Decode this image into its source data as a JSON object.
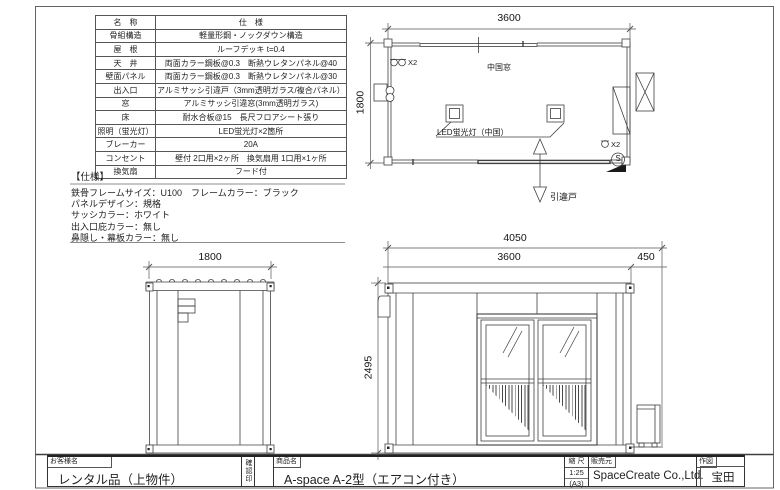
{
  "spec_table": {
    "header": {
      "name": "名　称",
      "spec": "仕　様"
    },
    "rows": [
      {
        "name": "骨組構造",
        "spec": "軽量形鋼・ノックダウン構造"
      },
      {
        "name": "屋　根",
        "spec": "ルーフデッキ t=0.4"
      },
      {
        "name": "天　井",
        "spec": "両面カラー鋼板@0.3　断熱ウレタンパネル@40"
      },
      {
        "name": "壁面パネル",
        "spec": "両面カラー鋼板@0.3　断熱ウレタンパネル@30"
      },
      {
        "name": "出入口",
        "spec": "アルミサッシ引違戸（3mm透明ガラス/複合パネル）"
      },
      {
        "name": "窓",
        "spec": "アルミサッシ引違窓(3mm透明ガラス)"
      },
      {
        "name": "床",
        "spec": "耐水合板@15　長尺フロアシート張り"
      },
      {
        "name": "照明（蛍光灯）",
        "spec": "LED蛍光灯×2箇所"
      },
      {
        "name": "ブレーカー",
        "spec": "20A"
      },
      {
        "name": "コンセント",
        "spec": "壁付 2口用×2ヶ所　換気扇用 1口用×1ヶ所"
      },
      {
        "name": "換気扇",
        "spec": "フード付"
      }
    ]
  },
  "spec_notes": {
    "title": "【仕様】",
    "lines": [
      "鉄骨フレームサイズ：U100　フレームカラー：ブラック",
      "パネルデザイン：規格",
      "サッシカラー：ホワイト",
      "出入口庇カラー：無し",
      "鼻隠し・幕板カラー：無し"
    ]
  },
  "plan": {
    "dim_width": "3600",
    "dim_depth": "1800",
    "window_label": "中国窓",
    "light_label": "LED蛍光灯（中国）",
    "door_label": "引違戸",
    "outlet_count": "X2",
    "switch_letter": "S"
  },
  "side_elevation": {
    "dim_width": "1800"
  },
  "front_elevation": {
    "dim_total": "4050",
    "dim_body": "3600",
    "dim_offset": "450",
    "dim_height": "2495"
  },
  "title_block": {
    "customer_label": "お客様名",
    "customer_value": "レンタル品（上物件）",
    "stamp_label": "確認印",
    "product_label": "商品名",
    "product_value": "A-space A-2型（エアコン付き）",
    "scale_label": "縮 尺",
    "scale_value": "1:25",
    "scale_paper": "(A3)",
    "seller_label": "販売元",
    "seller_value": "SpaceCreate Co.,Ltd.",
    "author_label": "作図",
    "author_value": "宝田"
  },
  "colors": {
    "line": "#3f3f3f",
    "text": "#1f1f1f",
    "fill": "#ffffff"
  }
}
